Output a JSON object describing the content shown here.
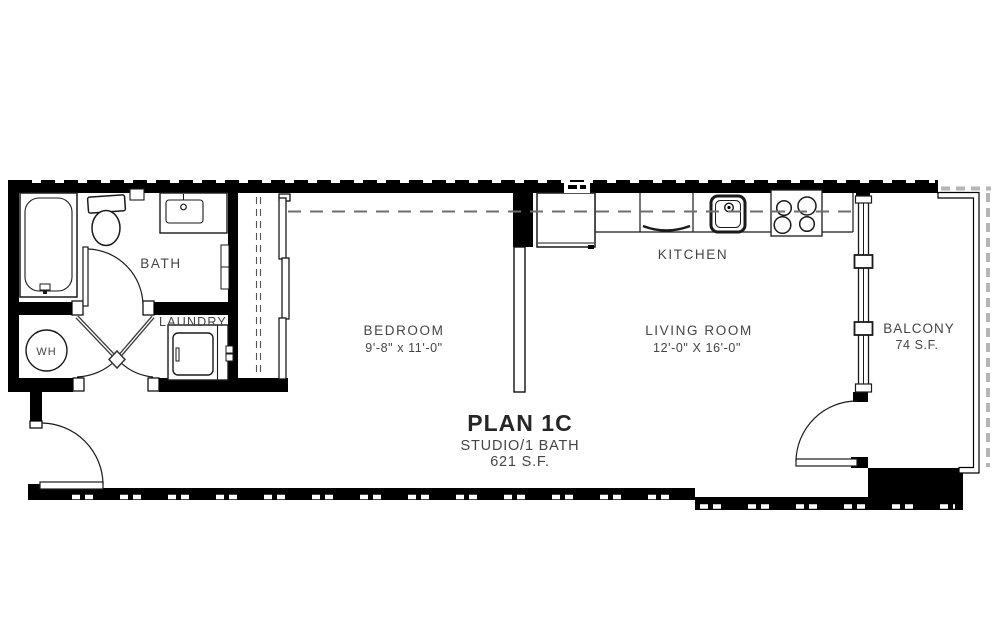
{
  "plan": {
    "title": "PLAN 1C",
    "subtitle": "STUDIO/1 BATH",
    "area": "621 S.F.",
    "rooms": {
      "bath": {
        "label": "BATH"
      },
      "laundry": {
        "label": "LAUNDRY"
      },
      "water_heater": {
        "label": "WH"
      },
      "bedroom": {
        "label": "BEDROOM",
        "dims": "9'-8\" x 11'-0\""
      },
      "kitchen": {
        "label": "KITCHEN"
      },
      "living_room": {
        "label": "LIVING ROOM",
        "dims": "12'-0\" X 16'-0\""
      },
      "balcony": {
        "label": "BALCONY",
        "area": "74 S.F."
      }
    },
    "fixtures": [
      "bathtub",
      "toilet",
      "vanity-sink",
      "medicine-cabinet",
      "water-heater",
      "washer",
      "closet-sliding-doors",
      "refrigerator",
      "dishwasher",
      "kitchen-sink",
      "range-cooktop",
      "balcony-windows",
      "balcony-railing"
    ],
    "colors": {
      "wall": "#000000",
      "line": "#1a1a1a",
      "text": "#454545",
      "dash": "#6e6e6e",
      "hatch": "#b5b5b5"
    }
  }
}
